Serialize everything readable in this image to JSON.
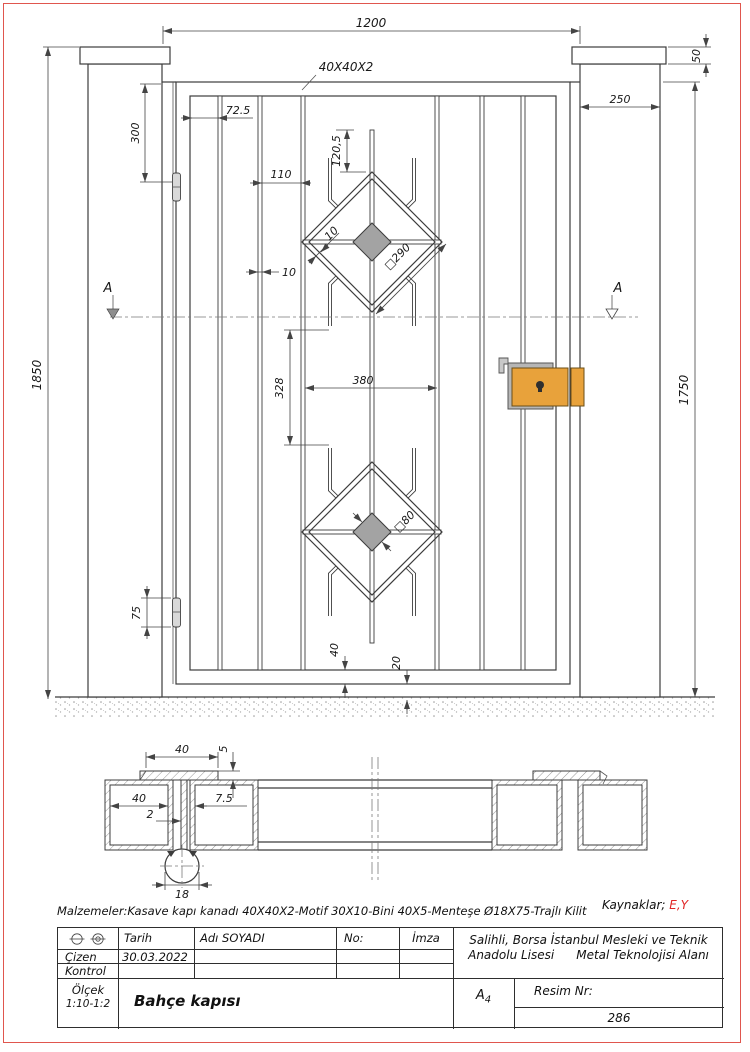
{
  "front_view": {
    "dims": {
      "opening_width": "1200",
      "profile": "40X40X2",
      "cap_height": "50",
      "post_width": "250",
      "top_offset": "300",
      "first_bar": "72.5",
      "bar_spacing": "110",
      "bar_thickness": "10",
      "spoke_length": "120,5",
      "motif_bar_gap": "10",
      "motif_diamond": "□290",
      "motif_square": "□80",
      "overall_height": "1850",
      "leaf_height": "1750",
      "motif_offset": "328",
      "motif_width": "380",
      "hinge_length": "75",
      "bottom_rail": "40",
      "ground_gap": "20",
      "section_label": "A"
    }
  },
  "section_view": {
    "dims": {
      "bini_width": "40",
      "bini_thickness": "5",
      "tube_width": "40",
      "wall_thickness": "2",
      "gap": "7.5",
      "hinge_diameter": "18"
    }
  },
  "notes": {
    "materials": "Malzemeler:Kasave kapı kanadı 40X40X2-Motif 30X10-Bini 40X5-Menteşe Ø18X75-Trajlı Kilit",
    "sources_label": "Kaynaklar;",
    "sources_value": "E,Y"
  },
  "title_block": {
    "date_label": "Tarih",
    "name_label": "Adı SOYADI",
    "no_label": "No:",
    "signature_label": "İmza",
    "drawn_label": "Çizen",
    "drawn_date": "30.03.2022",
    "control_label": "Kontrol",
    "scale_label": "Ölçek",
    "scale_value": "1:10-1:2",
    "drawing_title": "Bahçe kapısı",
    "school_line1": "Salihli, Borsa İstanbul Mesleki ve Teknik",
    "school_line2_left": "Anadolu Lisesi",
    "school_line2_right": "Metal Teknolojisi Alanı",
    "paper_size": "A",
    "paper_size_index": "4",
    "drawing_no_label": "Resim Nr:",
    "drawing_no_value": "286"
  }
}
